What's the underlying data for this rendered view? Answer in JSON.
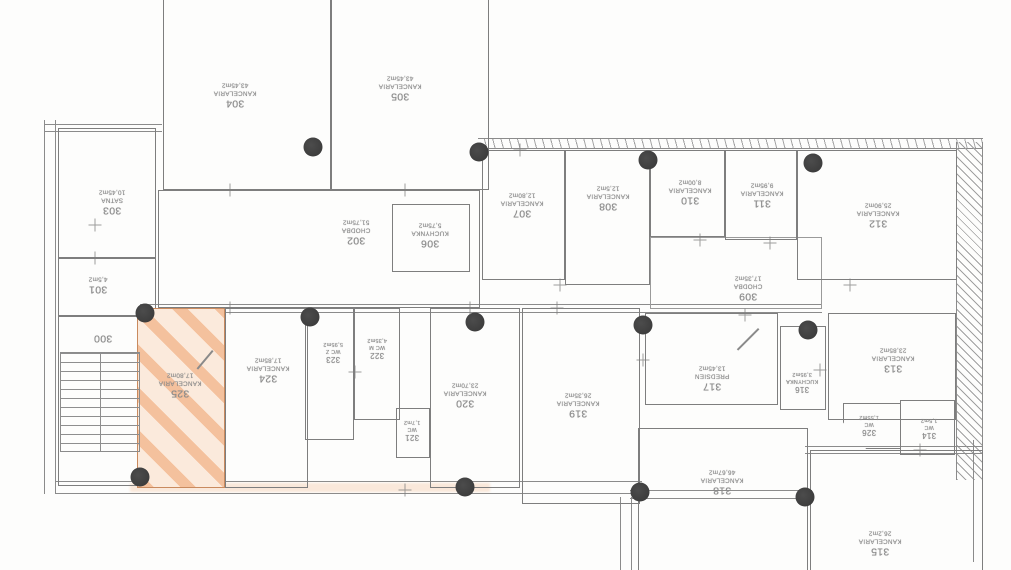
{
  "plan": {
    "highlighted_room": "325",
    "colors": {
      "highlight_fill": "#fbeadb",
      "highlight_stripe": "#ee9860",
      "wall_line": "#7e7e7e",
      "column_dot": "#3c3c3c"
    }
  },
  "rooms": [
    {
      "number": "300",
      "name": "",
      "area": ""
    },
    {
      "number": "301",
      "name": "",
      "area": "4,5m2"
    },
    {
      "number": "302",
      "name": "CHODBA",
      "area": "51,75m2"
    },
    {
      "number": "303",
      "name": "SATNA",
      "area": "10,45m2"
    },
    {
      "number": "304",
      "name": "KANCELARIA",
      "area": "43,45m2"
    },
    {
      "number": "305",
      "name": "KANCELARIA",
      "area": "43,45m2"
    },
    {
      "number": "306",
      "name": "KUCHYNKA",
      "area": "5,75m2"
    },
    {
      "number": "307",
      "name": "KANCELARIA",
      "area": "12,80m2"
    },
    {
      "number": "308",
      "name": "KANCELARIA",
      "area": "12,5m2"
    },
    {
      "number": "309",
      "name": "CHODBA",
      "area": "17,35m2"
    },
    {
      "number": "310",
      "name": "KANCELARIA",
      "area": "8,00m2"
    },
    {
      "number": "311",
      "name": "KANCELARIA",
      "area": "9,95m2"
    },
    {
      "number": "312",
      "name": "KANCELARIA",
      "area": "25,90m2"
    },
    {
      "number": "313",
      "name": "KANCELARIA",
      "area": "23,85m2"
    },
    {
      "number": "314",
      "name": "WC",
      "area": "1,5m2"
    },
    {
      "number": "315",
      "name": "KANCELARIA",
      "area": "26,2m2"
    },
    {
      "number": "316",
      "name": "KUCHYNKA",
      "area": "3,95m2"
    },
    {
      "number": "317",
      "name": "PREDSIEN",
      "area": "13,45m2"
    },
    {
      "number": "318",
      "name": "KANCELARIA",
      "area": "46,67m2"
    },
    {
      "number": "319",
      "name": "KANCELARIA",
      "area": "26,35m2"
    },
    {
      "number": "320",
      "name": "KANCELARIA",
      "area": "23,70m2"
    },
    {
      "number": "321",
      "name": "WC",
      "area": "1,7m2"
    },
    {
      "number": "322",
      "name": "WC M",
      "area": "4,35m2"
    },
    {
      "number": "323",
      "name": "WC Z",
      "area": "5,95m2"
    },
    {
      "number": "324",
      "name": "KANCELARIA",
      "area": "17,85m2"
    },
    {
      "number": "325",
      "name": "KANCELARIA",
      "area": "17,80m2"
    },
    {
      "number": "326",
      "name": "WC",
      "area": "1,55m2"
    }
  ]
}
